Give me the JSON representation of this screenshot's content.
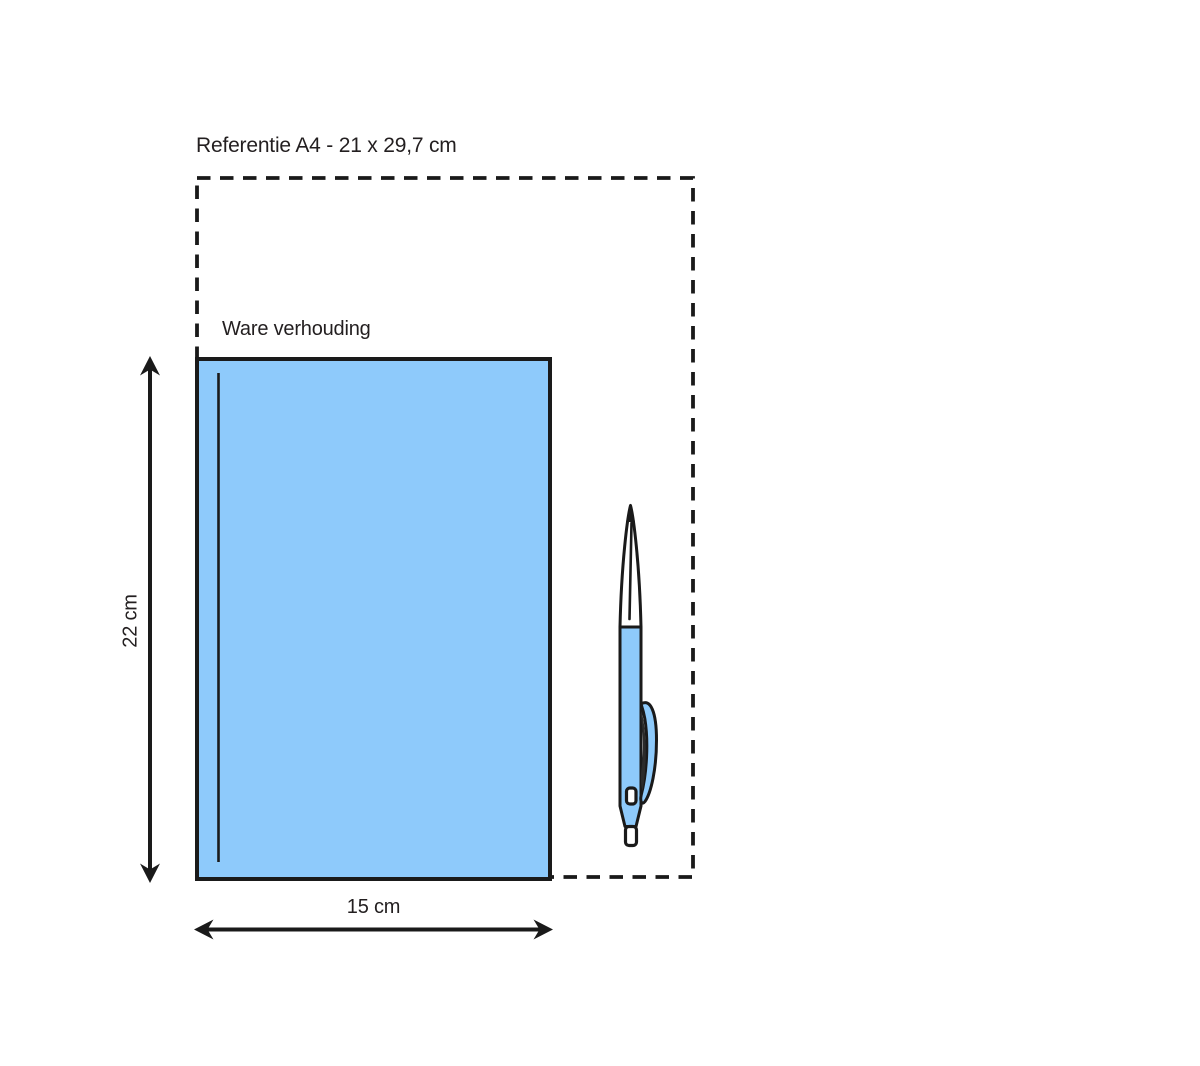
{
  "diagram": {
    "reference": {
      "label": "Referentie A4 - 21 x 29,7 cm",
      "width_cm": "21",
      "height_cm": "29,7"
    },
    "product": {
      "label": "Ware verhouding",
      "height_label": "22 cm",
      "width_label": "15 cm",
      "height_cm": "22",
      "width_cm": "15"
    },
    "icons": {
      "pen": "ballpoint-pen-illustration"
    }
  },
  "colors": {
    "background": "#FFFFFF",
    "paper_fill": "#8ECAFB",
    "outline": "#1A1A1A",
    "text": "#231F20",
    "clip_shadow": "#2B2B2B"
  }
}
